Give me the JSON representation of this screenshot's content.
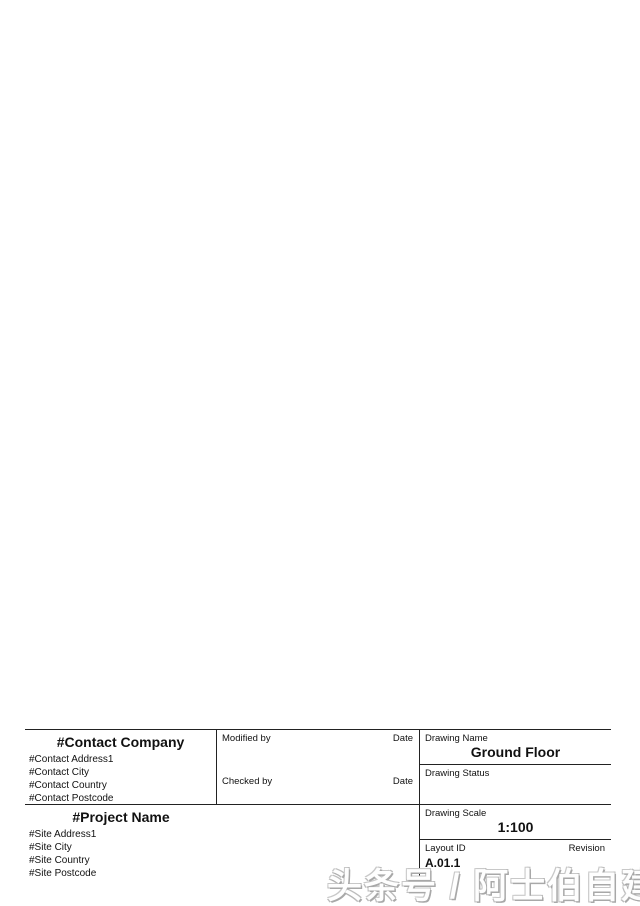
{
  "sheet": {
    "drawing_title": "一层平面图",
    "watermark": "头条号 / 阿士伯自建房"
  },
  "plan": {
    "rooms": {
      "balcony": "阳台",
      "hall": "厅堂",
      "kitchen": "厨房",
      "dining": "餐厅",
      "living": "客厅",
      "master_bedroom": "主卧",
      "garage": "车库"
    },
    "stair_up": "上",
    "stair_down": "下",
    "pantry_symbol": "✳",
    "dimensions": {
      "top_total": "10.450",
      "top_row": [
        "1.700",
        "3.000",
        "0.600",
        "3.250",
        "3.600",
        "1.700"
      ],
      "bottom_row": [
        "1.700",
        "3.600",
        "3.250",
        "3.600"
      ],
      "bottom_total": "10.450",
      "left_total": "13.200",
      "left_segments": [
        "6.500",
        "6.700",
        "2.000"
      ],
      "right_total": "13.200",
      "right_segments": [
        "6.500",
        "2.100",
        "4.600",
        "2.000"
      ]
    },
    "colors": {
      "boundary_cyan": "#5fc9c9",
      "wall": "#1a1a1a",
      "column_fill": "#d6caa2",
      "column_stroke": "#95402c",
      "column_red": "#c8594a",
      "window_tan": "#ecd9ad",
      "door_orange": "#cf9a63",
      "dimension_blue": "#3a3ac8",
      "room_label_blue": "#5c5cd6"
    }
  },
  "title_block": {
    "contact_company": "#Contact Company",
    "contact_lines": [
      "#Contact Address1",
      "#Contact City",
      "#Contact Country",
      "#Contact Postcode"
    ],
    "project_name": "#Project Name",
    "site_lines": [
      "#Site Address1",
      "#Site City",
      "#Site Country",
      "#Site Postcode"
    ],
    "modified_by_label": "Modified by",
    "checked_by_label": "Checked by",
    "date_label": "Date",
    "drawing_name_label": "Drawing Name",
    "drawing_name": "Ground Floor",
    "drawing_status_label": "Drawing Status",
    "drawing_scale_label": "Drawing Scale",
    "drawing_scale": "1:100",
    "layout_id_label": "Layout ID",
    "layout_id": "A.01.1",
    "revision_label": "Revision"
  }
}
